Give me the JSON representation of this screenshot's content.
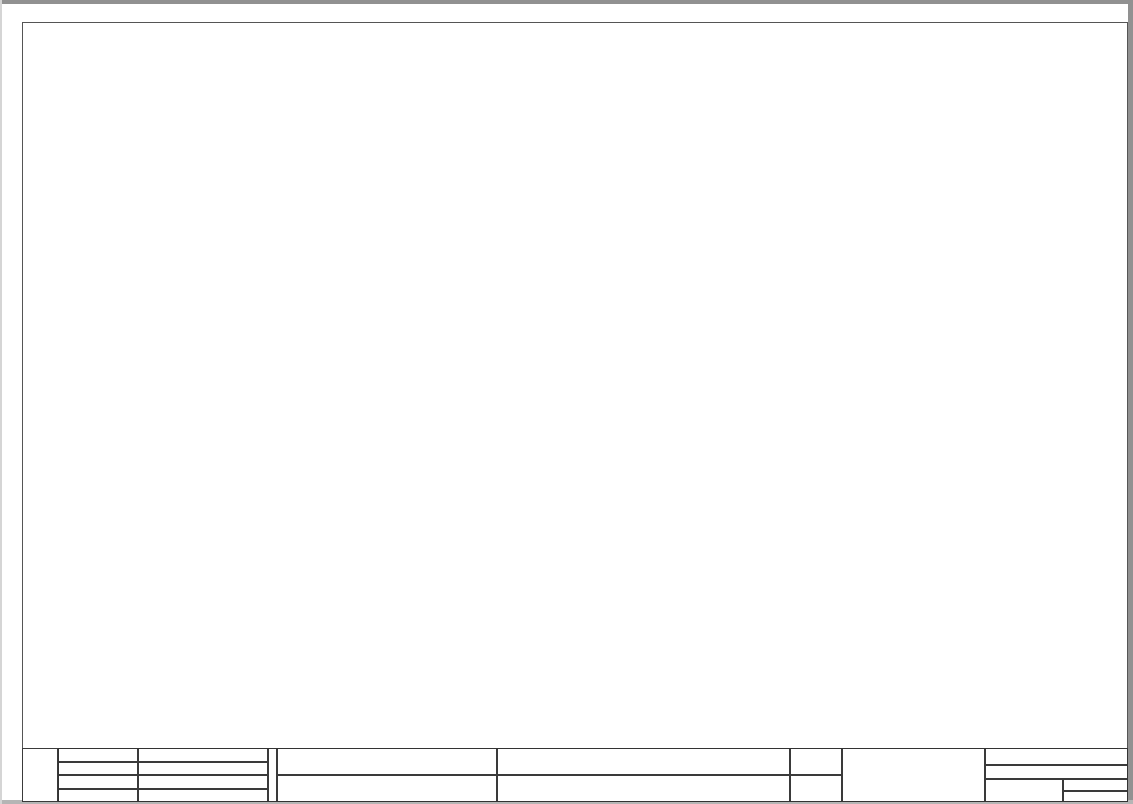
{
  "frame": {
    "columns": [
      "0",
      "1",
      "2",
      "3",
      "4",
      "5",
      "6",
      "7",
      "8",
      "9"
    ],
    "rows": [
      "A",
      "B",
      "C",
      "D",
      "E",
      "F"
    ]
  },
  "nets": {
    "left": [
      {
        "ref": "1.c.9",
        "name": "0V2"
      },
      {
        "ref": "1.c.0",
        "name": "24V1"
      },
      {
        "ref": "2.1",
        "name": "0V1"
      },
      {
        "ref": "2.6",
        "name": "24V3"
      },
      {
        "ref": "1.c.9",
        "name": "0V3"
      }
    ],
    "right": [
      {
        "name": "0V2",
        "ref": "1.c.1"
      },
      {
        "name": "0V3",
        "ref": "1.c.0"
      }
    ]
  },
  "ground": {
    "tag": "-A2",
    "pin": "1"
  },
  "modules": [
    {
      "id": "K1",
      "type": "cpu",
      "name": "-K1",
      "refs": [
        "/1.d.0",
        "/1.j.0"
      ],
      "top": [
        {
          "label": "X10",
          "pins": [
            "1",
            "2",
            "3",
            "4",
            "5",
            "6"
          ]
        },
        {
          "label": "X11",
          "pins": [
            "1",
            "4"
          ]
        }
      ],
      "bottom": [
        {
          "label": "X12",
          "pins": [
            "1",
            "2"
          ]
        }
      ],
      "labels": {
        "psu1_box": "L+ M",
        "psu1": "24VDC",
        "psu2_box": "L+ M",
        "psu2": "24VDC",
        "di_box": "1M .0 .1 .2 .3 .4 .5 .6 .7   .0 .1 .2 .3 .4 .5",
        "di_caption": "24VDC INPUTS",
        "aq_box": "2M 0  AQ",
        "aq_caption": "ANALOG OUTPUTS",
        "ai_box": "3M 0 1  AI",
        "ai_caption": "ANALOG INPUTS",
        "status": [
          "RUN / STOP",
          "ERROR",
          "MAINT"
        ],
        "dia_bits": "0 .1 .2 .3 .4 .5 .6 .7",
        "dia_name": "DI a",
        "dib_bits": "0 .1 .2 .3 .4",
        "dib_name": "DI b",
        "cpu_title": "CPU 1215C",
        "cpu_sub": "DC/DC/DC",
        "dqa_name": "DQ a",
        "dqa_bits": "0 .1 .2 .3 .4 .5 .6 .7",
        "dqb_name": "DQ b",
        "dqb_bits": "0 .1",
        "part": "215-1AG40-0XB0",
        "link": "LINK",
        "rxtx": "Rx / Tx",
        "port1": "X1 P1",
        "port2": "X1 P2",
        "profinet": "PROFINET (LAN)",
        "mac": "MAC ADRESS",
        "out_caption": "24VDC OUTPUTS",
        "out_dqa": "DQ a",
        "out_dqb": "DQ b",
        "out_bits": "4L+ 4M .0 .1 .2 .3 .4 .5 .6 .7   .0 .1"
      }
    },
    {
      "id": "K2",
      "type": "sm1221",
      "name": "-K2",
      "refs": [
        "/1.e.1",
        "/1.k.0"
      ],
      "top": [
        {
          "label": "X10",
          "pins": [
            "3"
          ]
        },
        {
          "label": "X11",
          "pins": [
            "1",
            "3"
          ]
        }
      ],
      "bottom": [
        {
          "label": "X12",
          "pins": [
            "2"
          ]
        },
        {
          "label": "X13",
          "pins": [
            "2"
          ]
        }
      ],
      "labels": {
        "side_top": "24VDC INPUTS",
        "side_bottom": "24VDC INPUTS",
        "row1_head": "X10",
        "row1": "1M .0 .1 .2 .3",
        "row1_tail": "DI a",
        "row2_head": "X11",
        "row2": "2M .4 .5 .6 .7",
        "diag": "DIAG",
        "led1_bits": ".0 .1 .2 .3 .4 .5 .6 .7",
        "led1_name": "DI a",
        "title": "SM 1221",
        "subtitle": "DC",
        "led2_name": "DI b",
        "led2_bits": ".0 .1 .2 .3 .4 .5 .6 .7",
        "row3_head": "X12",
        "row3": "3M .0 .1 .2",
        "row3_tail": "DI b",
        "row4_head": "X13",
        "row4": "4M .4 .5 .6 .7",
        "part": "6ES7 221-1BF32-0XB0"
      }
    },
    {
      "id": "K3",
      "type": "sm1221",
      "name": "-K3",
      "refs": [
        "/1.f.0"
      ],
      "top": [
        {
          "label": "X10",
          "pins": [
            "3"
          ]
        },
        {
          "label": "X11",
          "pins": [
            "1",
            "3"
          ]
        }
      ],
      "bottom": [
        {
          "label": "X12",
          "pins": [
            "2"
          ]
        },
        {
          "label": "X13",
          "pins": [
            "2"
          ]
        }
      ],
      "labels": {
        "side_top": "24VDC INPUTS",
        "side_bottom": "24VDC INPUTS",
        "row1_head": "X10",
        "row1": "1M .0 .1 .2 .3",
        "row1_tail": "DI a",
        "row2_head": "X11",
        "row2": "2M .4 .5 .6 .7",
        "diag": "DIAG",
        "led1_bits": ".0 .1 .2 .3 .4 .5 .6 .7",
        "led1_name": "DI a",
        "title": "SM 1221",
        "subtitle": "DC",
        "led2_name": "DI b",
        "led2_bits": ".0 .1 .2 .3 .4 .5 .6 .7",
        "row3_head": "X12",
        "row3": "3M .0 .1 .2",
        "row3_tail": "DI b",
        "row4_head": "X13",
        "row4": "4M .4 .5 .6 .7",
        "part": "6ES7 221-1BF32-0XB0"
      }
    },
    {
      "id": "K4",
      "type": "sm1222",
      "name": "-K4",
      "refs": [
        "/1.f.1",
        "/1.g.1"
      ],
      "top": [
        {
          "label": "X10",
          "pins": [
            "1",
            "2",
            "3",
            "4"
          ]
        }
      ],
      "bottom": [
        {
          "label": "X11",
          "pins": [
            "2"
          ]
        }
      ],
      "labels": {
        "term_head": "X10",
        "box1": "L+ M",
        "box2": "1L .0 .1 .2",
        "box2_name": "DQ a",
        "cap1": "24VDC",
        "cap2": "RELAY OUTPUTS",
        "diag": "DIAG",
        "led1_bits": ".0 .1 .2",
        "led1_name": "DQ a",
        "title": "SM 1222",
        "subtitle": "RLY",
        "led2_name": "DQ a",
        "led2_bits": ".3 .4 .5 .6 .7",
        "part": "6ES7 222-1BF32-0XB0",
        "out_caption": "RELAY OUTPUTS",
        "out_name": "DQ a",
        "out_row": "2L .3 .4 .5 .6 .7",
        "out_tail": "X11"
      }
    },
    {
      "id": "K5",
      "type": "sm1222",
      "name": "-K5",
      "refs": [
        "/1.h.0",
        "/1.i.0"
      ],
      "top": [
        {
          "label": "X10",
          "pins": [
            "1",
            "2",
            "3",
            "4"
          ]
        }
      ],
      "bottom": [
        {
          "label": "X11",
          "pins": [
            "2"
          ]
        }
      ],
      "labels": {
        "term_head": "X10",
        "box1": "L+ M",
        "box2": "1L .0 .1 .2",
        "box2_name": "DQ a",
        "cap1": "24VDC",
        "cap2": "RELAY OUTPUTS",
        "diag": "DIAG",
        "led1_bits": ".0 .1 .2",
        "led1_name": "DQ a",
        "title": "SM 1222",
        "subtitle": "RLY",
        "led2_name": "DQ a",
        "led2_bits": ".3 .4 .5 .6 .7",
        "part": "6ES7 222-1BF32-0XB0",
        "out_caption": "RELAY OUTPUTS",
        "out_name": "DQ a",
        "out_row": "2L .3 .4 .5 .6 .7",
        "out_tail": "X11"
      }
    }
  ],
  "titleblock": {
    "rows": [
      {
        "label": "创建者",
        "value": "庞露伟19"
      },
      {
        "label": "创建时间",
        "value": "10:31:34"
      },
      {
        "label": "审核人",
        "value": "黄文"
      },
      {
        "label": "审核时间",
        "value": ""
      }
    ],
    "project_label": "项目名称",
    "project_value": "电源标准柜",
    "page_label": "当前页名",
    "page_value": "PLC总览",
    "org": "智能制造工程学院",
    "plant": "= CZJK-A",
    "location": "+ Control",
    "doc_no": "1240260219",
    "sheet_label": "页数",
    "sheet_value": "1.0",
    "pageno_label": "页",
    "pageno_value": "3/22"
  }
}
